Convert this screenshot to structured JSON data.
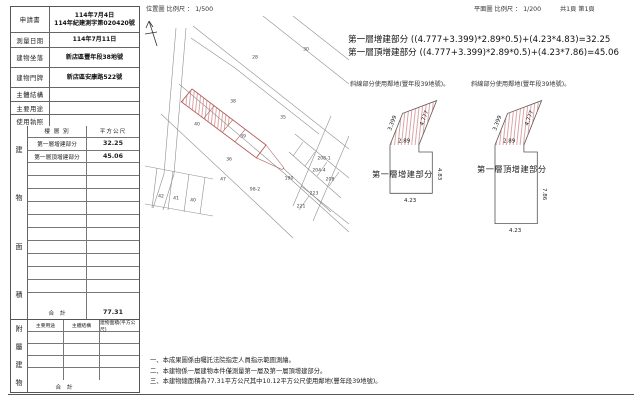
{
  "header": {
    "location_scale": "位置圖 比例尺 ： 1/500",
    "plan_scale": "平面圖 比例尺 ： 1/200",
    "page_info": "共1頁 第1頁"
  },
  "info_table": {
    "rows": [
      {
        "label": "申請書",
        "values": [
          "114年7月4日",
          "114年紀建測字第020420號"
        ]
      },
      {
        "label": "測量日期",
        "values": [
          "114年7月11日"
        ]
      },
      {
        "label": "建物坐落",
        "values": [
          "新店區豐年段38地號"
        ]
      },
      {
        "label": "建物門牌",
        "values": [
          "新店區安康路522號"
        ]
      },
      {
        "label": "主體結構",
        "values": []
      },
      {
        "label": "主要用途",
        "values": []
      },
      {
        "label": "使用執照",
        "values": []
      }
    ]
  },
  "area_table": {
    "side_label": "建物面積",
    "col1": "樓 層 別",
    "col2": "平方公尺",
    "rows": [
      {
        "label": "第一層增建部分",
        "value": "32.25"
      },
      {
        "label": "第一層頂增建部分",
        "value": "45.06"
      }
    ],
    "total_label": "合　計",
    "total_value": "77.31"
  },
  "annex_table": {
    "side_label": "附屬建物",
    "headers": [
      "主要用途",
      "主體結構",
      "建物面積(平方公尺)"
    ],
    "total_label": "合　計"
  },
  "formulas": [
    "第一層增建部分 ((4.777+3.399)*2.89*0.5)+(4.23*4.83)=32.25",
    "第一層頂增建部分 ((4.777+3.399)*2.89*0.5)+(4.23*7.86)=45.06"
  ],
  "diagrams": [
    {
      "caption": "斜線部分使用鄰地(豐年段39地號)。",
      "name": "第一層增建部分",
      "side_left": "3.399",
      "side_right": "4.777",
      "top_width": "2.89",
      "height": "4.83",
      "bottom": "4.23"
    },
    {
      "caption": "斜線部分使用鄰地(豐年段39地號)。",
      "name": "第一層頂增建部分",
      "side_left": "3.399",
      "side_right": "4.777",
      "top_width": "2.89",
      "height": "7.86",
      "bottom": "4.23"
    }
  ],
  "notes": [
    "一、本成果圖係由囑託法院指定人員指示範圍測繪。",
    "二、本建物係一層建物本件僅測量第一層及第一層頂增建部分。",
    "三、本建物總面積為77.31平方公尺其中10.12平方公尺使用鄰地(豐年段39地號)。"
  ],
  "map": {
    "labels": [
      {
        "text": "28",
        "x": 112,
        "y": 42
      },
      {
        "text": "30",
        "x": 163,
        "y": 34
      },
      {
        "text": "38",
        "x": 90,
        "y": 86
      },
      {
        "text": "40",
        "x": 54,
        "y": 109
      },
      {
        "text": "39",
        "x": 100,
        "y": 121
      },
      {
        "text": "35",
        "x": 140,
        "y": 102
      },
      {
        "text": "36",
        "x": 86,
        "y": 144
      },
      {
        "text": "47",
        "x": 80,
        "y": 164
      },
      {
        "text": "42",
        "x": 18,
        "y": 181
      },
      {
        "text": "41",
        "x": 33,
        "y": 183
      },
      {
        "text": "40",
        "x": 50,
        "y": 185
      },
      {
        "text": "190",
        "x": 146,
        "y": 163
      },
      {
        "text": "98-2",
        "x": 112,
        "y": 174
      },
      {
        "text": "208-1",
        "x": 181,
        "y": 143
      },
      {
        "text": "204-4",
        "x": 176,
        "y": 155
      },
      {
        "text": "208",
        "x": 187,
        "y": 164
      },
      {
        "text": "223",
        "x": 171,
        "y": 178
      },
      {
        "text": "221",
        "x": 158,
        "y": 191
      }
    ],
    "colors": {
      "parcel_outline": "#b25b5b",
      "hatch": "#c46a6a",
      "line": "#8f8f8f"
    }
  }
}
